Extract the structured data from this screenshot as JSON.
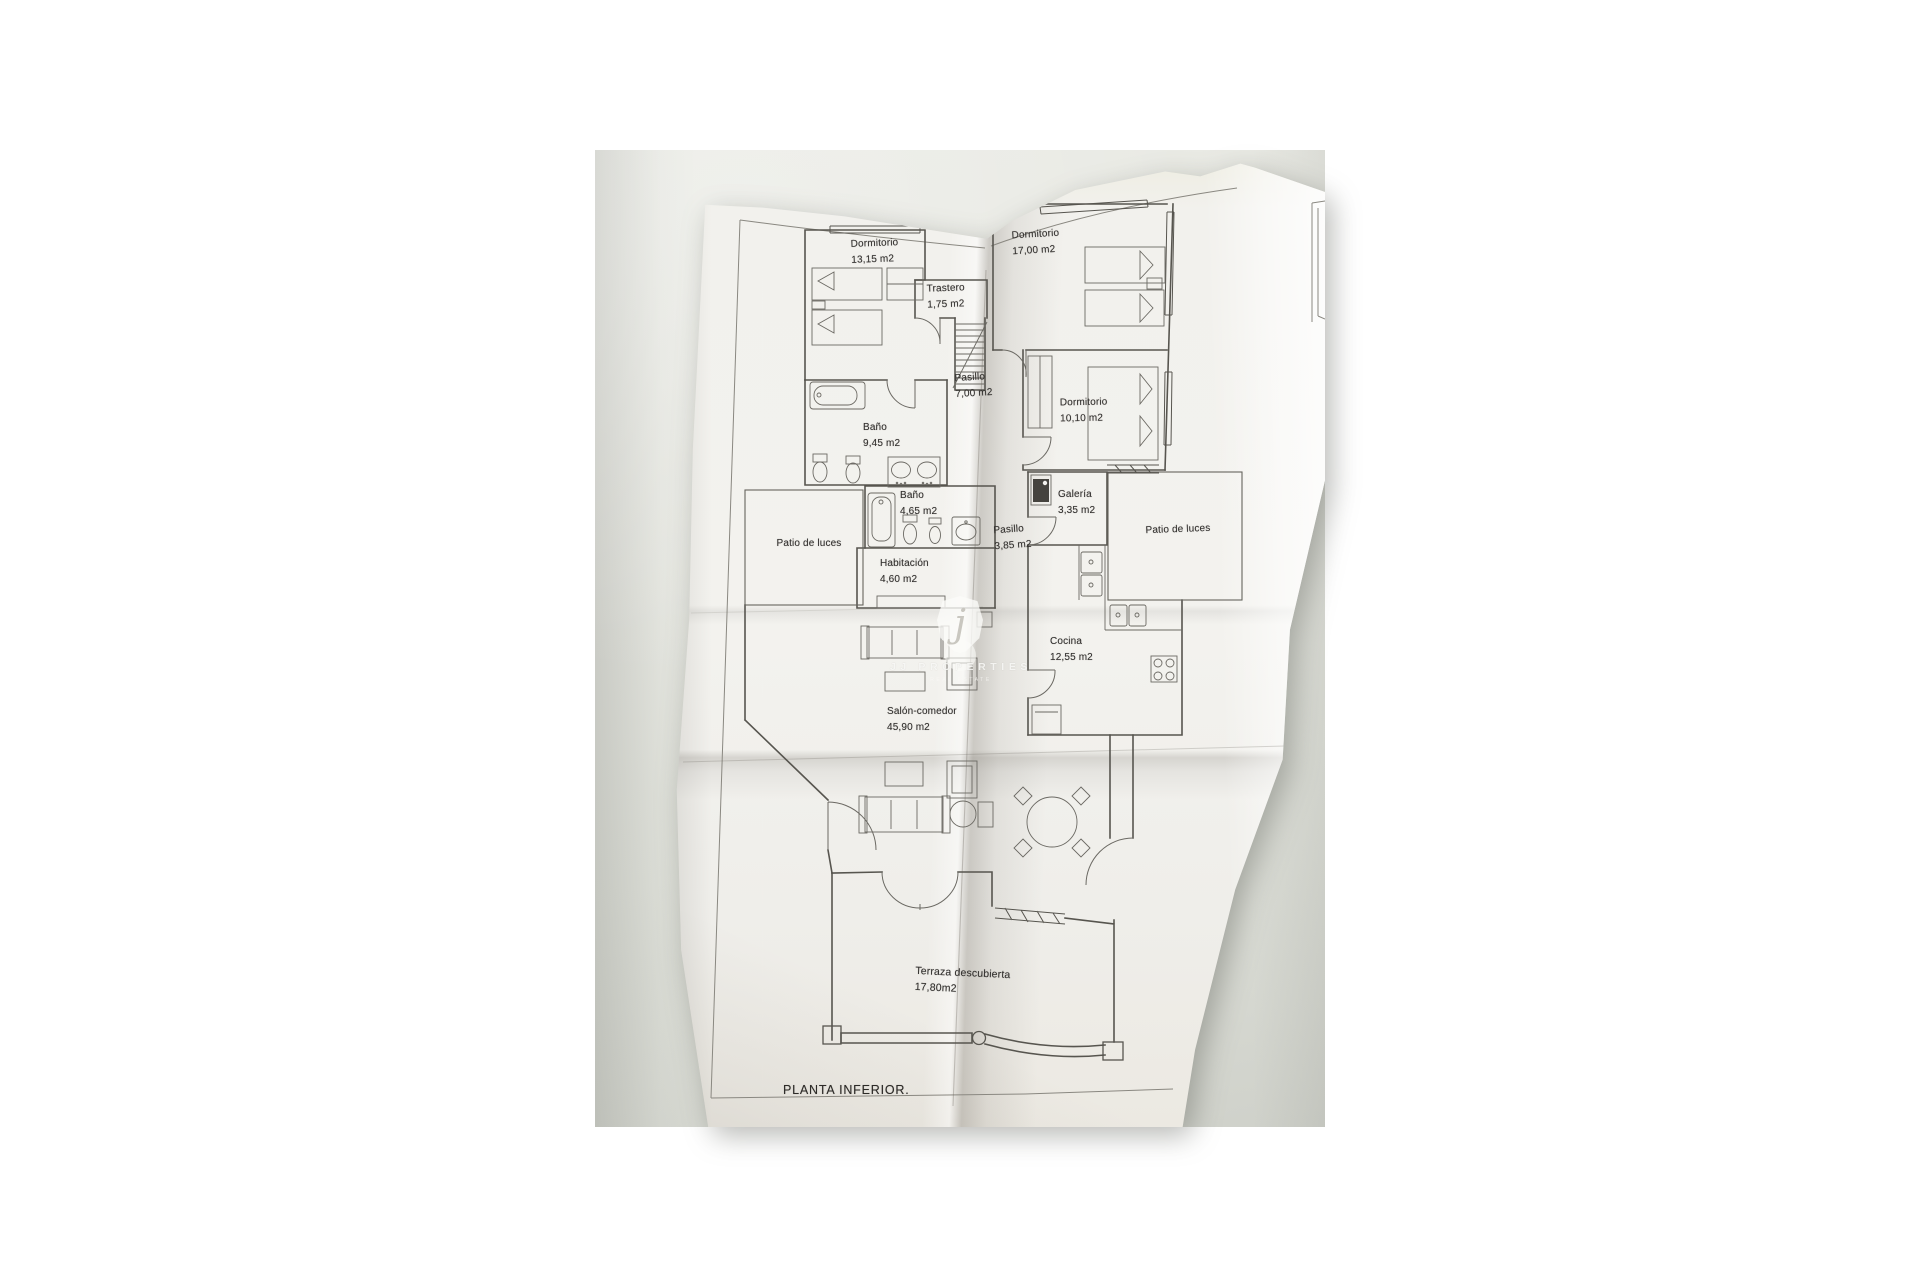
{
  "floorplan": {
    "title": "PLANTA INFERIOR.",
    "rooms": {
      "dormitorio_1": {
        "label": "Dormitorio",
        "area": "13,15 m2"
      },
      "dormitorio_2": {
        "label": "Dormitorio",
        "area": "17,00 m2"
      },
      "trastero": {
        "label": "Trastero",
        "area": "1,75 m2"
      },
      "pasillo_1": {
        "label": "Pasillo",
        "area": "7,00 m2"
      },
      "dormitorio_3": {
        "label": "Dormitorio",
        "area": "10,10 m2"
      },
      "bano_1": {
        "label": "Baño",
        "area": "9,45 m2"
      },
      "bano_2": {
        "label": "Baño",
        "area": "4,65 m2"
      },
      "galeria": {
        "label": "Galería",
        "area": "3,35 m2"
      },
      "patio_izquierdo": {
        "label": "Patio de luces"
      },
      "patio_derecho": {
        "label": "Patio de luces"
      },
      "pasillo_2": {
        "label": "Pasillo",
        "area": "3,85 m2"
      },
      "habitacion": {
        "label": "Habitación",
        "area": "4,60 m2"
      },
      "cocina": {
        "label": "Cocina",
        "area": "12,55 m2"
      },
      "salon_comedor": {
        "label": "Salón-comedor",
        "area": "45,90 m2"
      },
      "terraza": {
        "label": "Terraza descubierta",
        "area": "17,80m2"
      }
    },
    "watermark": {
      "brand": "JJ PROPERTIES",
      "subtitle": "REAL ESTATE",
      "monogram": "j"
    },
    "colors": {
      "wall_background": "#e2e4de",
      "paper": "#f3f2ee",
      "ink": "#57554f"
    }
  }
}
